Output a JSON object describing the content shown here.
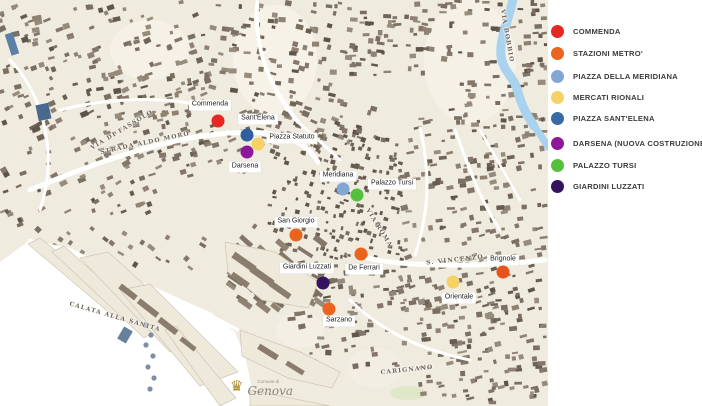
{
  "legend": {
    "items": [
      {
        "label": "COMMENDA",
        "color": "#e62822"
      },
      {
        "label": "STAZIONI METRO'",
        "color": "#eb641e"
      },
      {
        "label": "PIAZZA DELLA MERIDIANA",
        "color": "#82a7d4"
      },
      {
        "label": "MERCATI RIONALI",
        "color": "#f6d164"
      },
      {
        "label": "PIAZZA SANT'ELENA",
        "color": "#3b6ba5"
      },
      {
        "label": "DARSENA (NUOVA COSTRUZIONE)",
        "color": "#8e189c"
      },
      {
        "label": "PALAZZO TURSI",
        "color": "#53c13b"
      },
      {
        "label": "GIARDINI LUZZATI",
        "color": "#35125f"
      }
    ]
  },
  "map": {
    "markers": [
      {
        "id": "commenda",
        "label": "Commenda",
        "color": "#e62822",
        "x": 218,
        "y": 121,
        "lx": 210,
        "ly": 105
      },
      {
        "id": "sant-elena",
        "label": "Sant'Elena",
        "color": "#2f5f9e",
        "x": 247,
        "y": 135,
        "lx": 258,
        "ly": 119
      },
      {
        "id": "piazza-statuto",
        "label": "Piazza Statuto",
        "color": "#f6d164",
        "x": 258,
        "y": 144,
        "lx": 292,
        "ly": 138
      },
      {
        "id": "darsena",
        "label": "Darsena",
        "color": "#8e189c",
        "x": 247,
        "y": 152,
        "lx": 245,
        "ly": 167
      },
      {
        "id": "meridiana",
        "label": "Meridiana",
        "color": "#82a7d4",
        "x": 343,
        "y": 189,
        "lx": 338,
        "ly": 176
      },
      {
        "id": "palazzo-tursi",
        "label": "Palazzo Tursi",
        "color": "#53c13b",
        "x": 357,
        "y": 195,
        "lx": 392,
        "ly": 184
      },
      {
        "id": "san-giorgio",
        "label": "San Giorgio",
        "color": "#eb641e",
        "x": 296,
        "y": 235,
        "lx": 296,
        "ly": 222
      },
      {
        "id": "de-ferrari",
        "label": "De Ferrari",
        "color": "#eb641e",
        "x": 361,
        "y": 254,
        "lx": 364,
        "ly": 269
      },
      {
        "id": "giardini-luzzati",
        "label": "Giardini Luzzati",
        "color": "#35125f",
        "x": 323,
        "y": 283,
        "lx": 307,
        "ly": 268
      },
      {
        "id": "sarzano",
        "label": "Sarzano",
        "color": "#eb641e",
        "x": 329,
        "y": 309,
        "lx": 339,
        "ly": 321
      },
      {
        "id": "orientale",
        "label": "Orientale",
        "color": "#f6d164",
        "x": 453,
        "y": 282,
        "lx": 459,
        "ly": 298
      },
      {
        "id": "brignole",
        "label": "Brignole",
        "color": "#e8531c",
        "x": 503,
        "y": 272,
        "lx": 503,
        "ly": 260
      }
    ],
    "street_labels": [
      {
        "id": "strada-aldo-moro",
        "text": "STRADA ALDO MORO",
        "x": 145,
        "y": 143,
        "rotate": -12
      },
      {
        "id": "via-di-fassolo",
        "text": "VIA DI FASSOLO",
        "x": 122,
        "y": 130,
        "rotate": -31
      },
      {
        "id": "calata-alla-sanita",
        "text": "CALATA ALLA SANITA",
        "x": 115,
        "y": 317,
        "rotate": 16
      },
      {
        "id": "via-bobbio",
        "text": "VIA BOBBIO",
        "x": 507,
        "y": 36,
        "rotate": 80
      },
      {
        "id": "via-roma",
        "text": "VIA ROMA",
        "x": 379,
        "y": 228,
        "rotate": 58
      },
      {
        "id": "s-vincenzo",
        "text": "S. VINCENZO",
        "x": 455,
        "y": 260,
        "rotate": -6
      },
      {
        "id": "carignano",
        "text": "CARIGNANO",
        "x": 407,
        "y": 370,
        "rotate": -6
      }
    ],
    "logo": {
      "small": "Comune di",
      "name": "Genova"
    }
  }
}
